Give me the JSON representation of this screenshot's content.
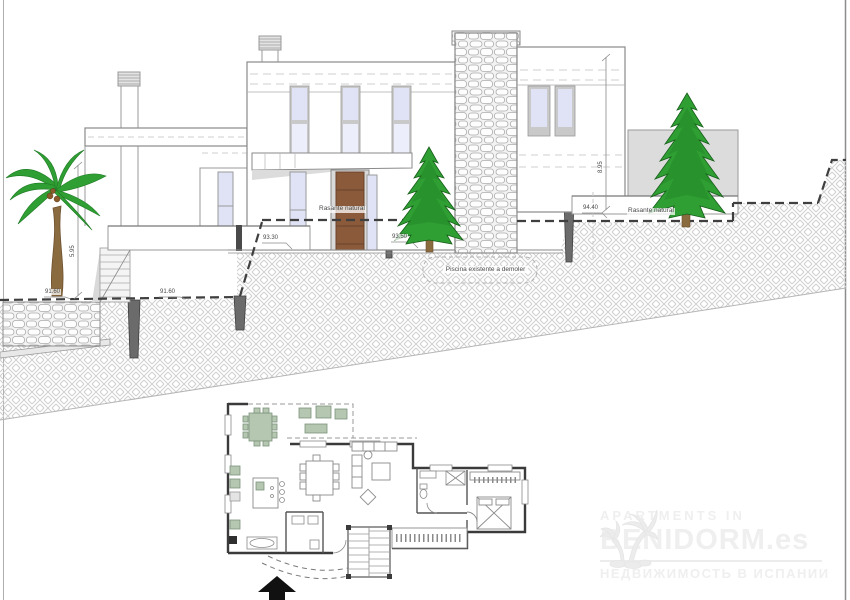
{
  "page": {
    "type": "architectural drawing sheet",
    "background": "#ffffff"
  },
  "elevation": {
    "labels": {
      "ground_label_left": "Rasante natural",
      "ground_label_right": "Rasante natural",
      "level_91_60_a": "91.60",
      "level_91_60_b": "91.60",
      "level_93_30": "93.30",
      "level_93_50": "93.50",
      "level_94_40": "94.40",
      "dim_left": "5.95",
      "dim_right": "8.95",
      "pool_note": "Piscina existente a demoler"
    }
  },
  "watermark": {
    "line1": "APARTMENTS IN",
    "line2": "BENIDORM.es",
    "line3": "НЕДВИЖИМОСТЬ В ИСПАНИИ"
  },
  "icons": {
    "north_arrow_icon": "filled-up-arrow",
    "palm_logo_icon": "palm-trees-silhouette"
  },
  "colors": {
    "accent_door": "#8a5a3b",
    "glass": "#dfe3f5",
    "tree_green": "#2f9e33",
    "palm_green": "#2f9e33",
    "trunk_brown": "#8a6a3f",
    "annex_gray": "#dcdcdc",
    "hatch_gray": "#cfcfcf",
    "ground_dash": "#3f3f3f",
    "terrace_furniture_green": "#b5c6b1",
    "watermark_gray": "#efefef"
  }
}
